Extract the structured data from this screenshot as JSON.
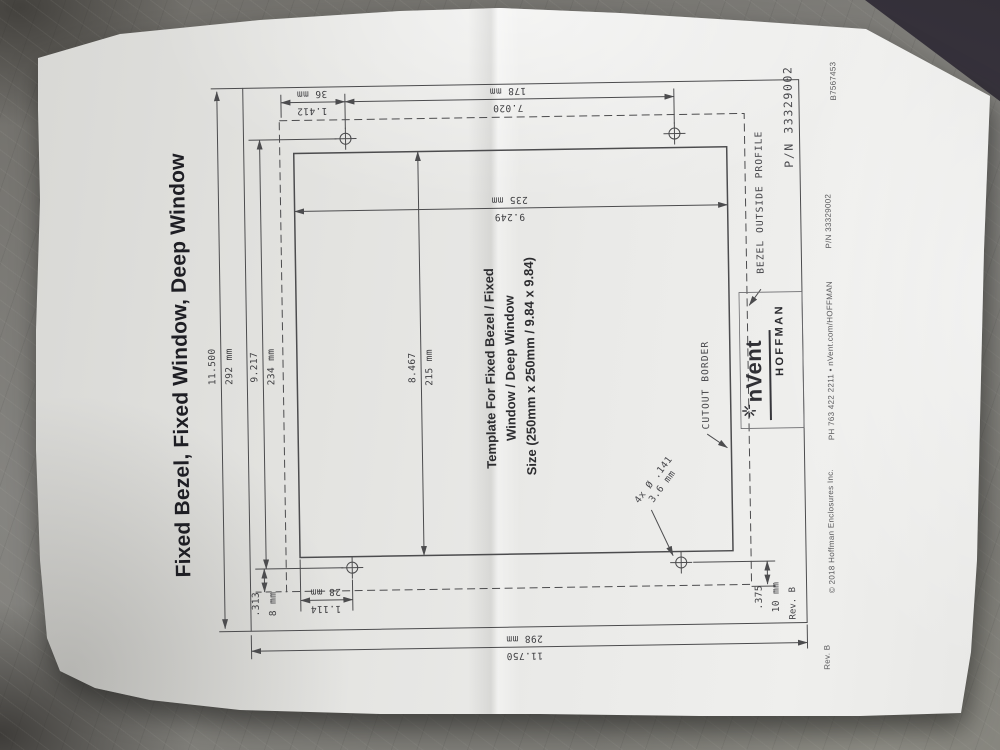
{
  "colors": {
    "paper": "#e9e9e7",
    "table": "#7d7b76",
    "line": "#4c4c4e",
    "ink": "#1e1e24"
  },
  "page": {
    "title": "Fixed Bezel, Fixed Window, Deep Window",
    "note": {
      "line1": "Template For Fixed Bezel / Fixed",
      "line2": "Window / Deep Window",
      "line3": "Size (250mm x 250mm / 9.84 x 9.84)"
    },
    "labels": {
      "cutout_border": "CUTOUT BORDER",
      "bezel_profile": "BEZEL OUTSIDE PROFILE",
      "holes_line1": "4x Ø .141",
      "holes_line2": "3.6 mm",
      "part_number": "P/N 33329002",
      "revision": "Rev. B"
    },
    "dims": {
      "overall_height": {
        "in": "11.500",
        "mm": "292 mm"
      },
      "corner_offset": {
        "in": "1.412",
        "mm": "36 mm"
      },
      "hole_span_width": {
        "in": "7.020",
        "mm": "178 mm"
      },
      "cutout_width": {
        "in": "9.249",
        "mm": "235 mm"
      },
      "hole_span_height": {
        "in": "9.217",
        "mm": "234 mm"
      },
      "cutout_height": {
        "in": "8.467",
        "mm": "215 mm"
      },
      "bottom_left_offset": {
        "in": ".313",
        "mm": "8 mm"
      },
      "hole_edge_offset": {
        "in": "1.114",
        "mm": "28 mm"
      },
      "bottom_right_offset": {
        "in": ".375",
        "mm": "10 mm"
      },
      "overall_width": {
        "in": "11.750",
        "mm": "298 mm"
      }
    },
    "logo": {
      "brand": "nVent",
      "sub_brand": "HOFFMAN"
    },
    "margin": {
      "doc_number": "B7567453",
      "part_number": "P/N 33329002",
      "contact": "PH 763 422 2211 • nVent.com/HOFFMAN",
      "copyright": "© 2018 Hoffman Enclosures Inc.",
      "revision": "Rev. B"
    }
  }
}
